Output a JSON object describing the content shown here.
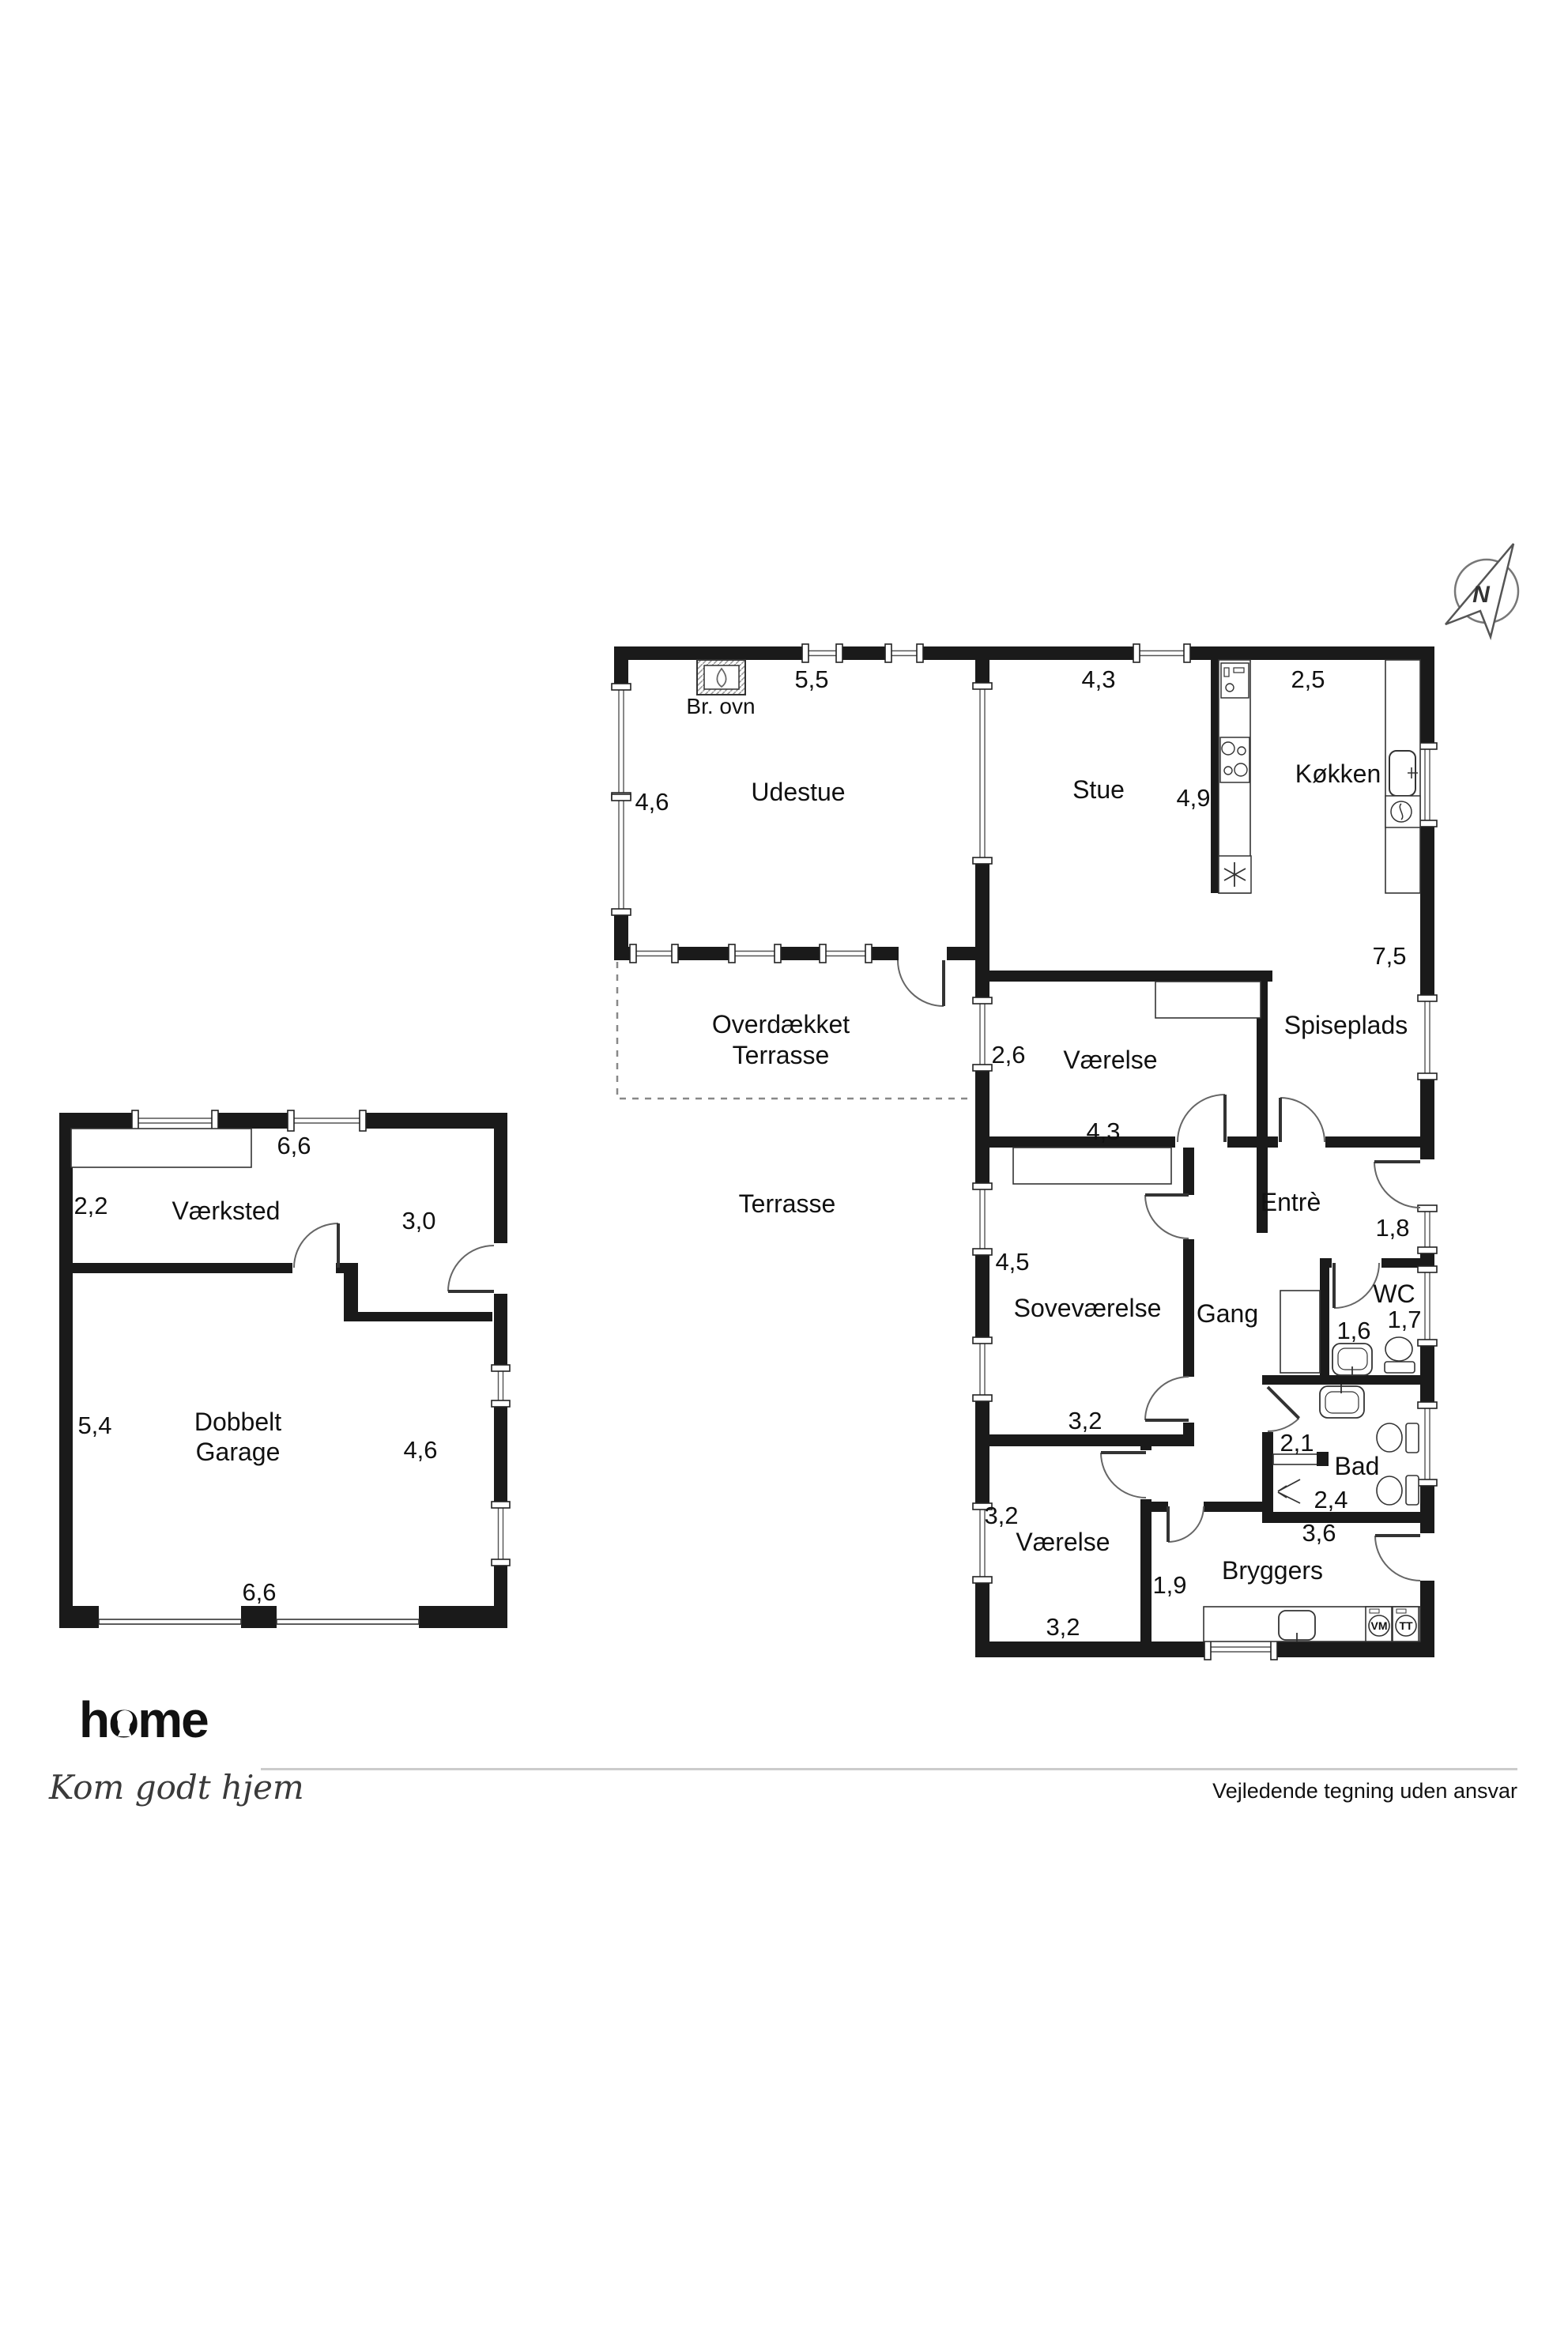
{
  "compass": {
    "n": "N"
  },
  "house": {
    "rooms": {
      "udestue": "Udestue",
      "stue": "Stue",
      "koekken": "Køkken",
      "spiseplads": "Spiseplads",
      "vaerelse_top": "Værelse",
      "entre": "Entrè",
      "sovevaerelse": "Soveværelse",
      "gang": "Gang",
      "wc": "WC",
      "bad": "Bad",
      "vaerelse_bottom": "Værelse",
      "bryggers": "Bryggers",
      "overdaekket_line1": "Overdækket",
      "overdaekket_line2": "Terrasse",
      "terrasse": "Terrasse",
      "br_ovn": "Br. ovn"
    },
    "dims": {
      "udestue_w": "5,5",
      "udestue_h": "4,6",
      "stue_w": "4,3",
      "koekken_w": "2,5",
      "stue_h": "4,9",
      "right_h": "7,5",
      "vaerelse_top_h": "2,6",
      "vaerelse_top_w": "4,3",
      "entre_w": "1,8",
      "sove_h": "4,5",
      "wc_w": "1,6",
      "wc_h": "1,7",
      "sove_w": "3,2",
      "bad_w1": "2,1",
      "bad_w2": "2,4",
      "bryggers_w": "3,6",
      "vaerelse_bottom_h": "3,2",
      "hall_w": "1,9",
      "vaerelse_bottom_w": "3,2"
    },
    "appliances": {
      "vm": "VM",
      "tt": "TT"
    }
  },
  "garage": {
    "rooms": {
      "vaerksted": "Værksted",
      "garage_line1": "Dobbelt",
      "garage_line2": "Garage"
    },
    "dims": {
      "top_w": "6,6",
      "vaerksted_h": "2,2",
      "vaerksted_r": "3,0",
      "left_h": "5,4",
      "right_h": "4,6",
      "bottom_w": "6,6"
    }
  },
  "footer": {
    "logo": "home",
    "tagline": "Kom godt hjem",
    "disclaimer": "Vejledende tegning uden ansvar"
  },
  "colors": {
    "brand_red": "#e30613",
    "wall": "#1a1a1a"
  }
}
